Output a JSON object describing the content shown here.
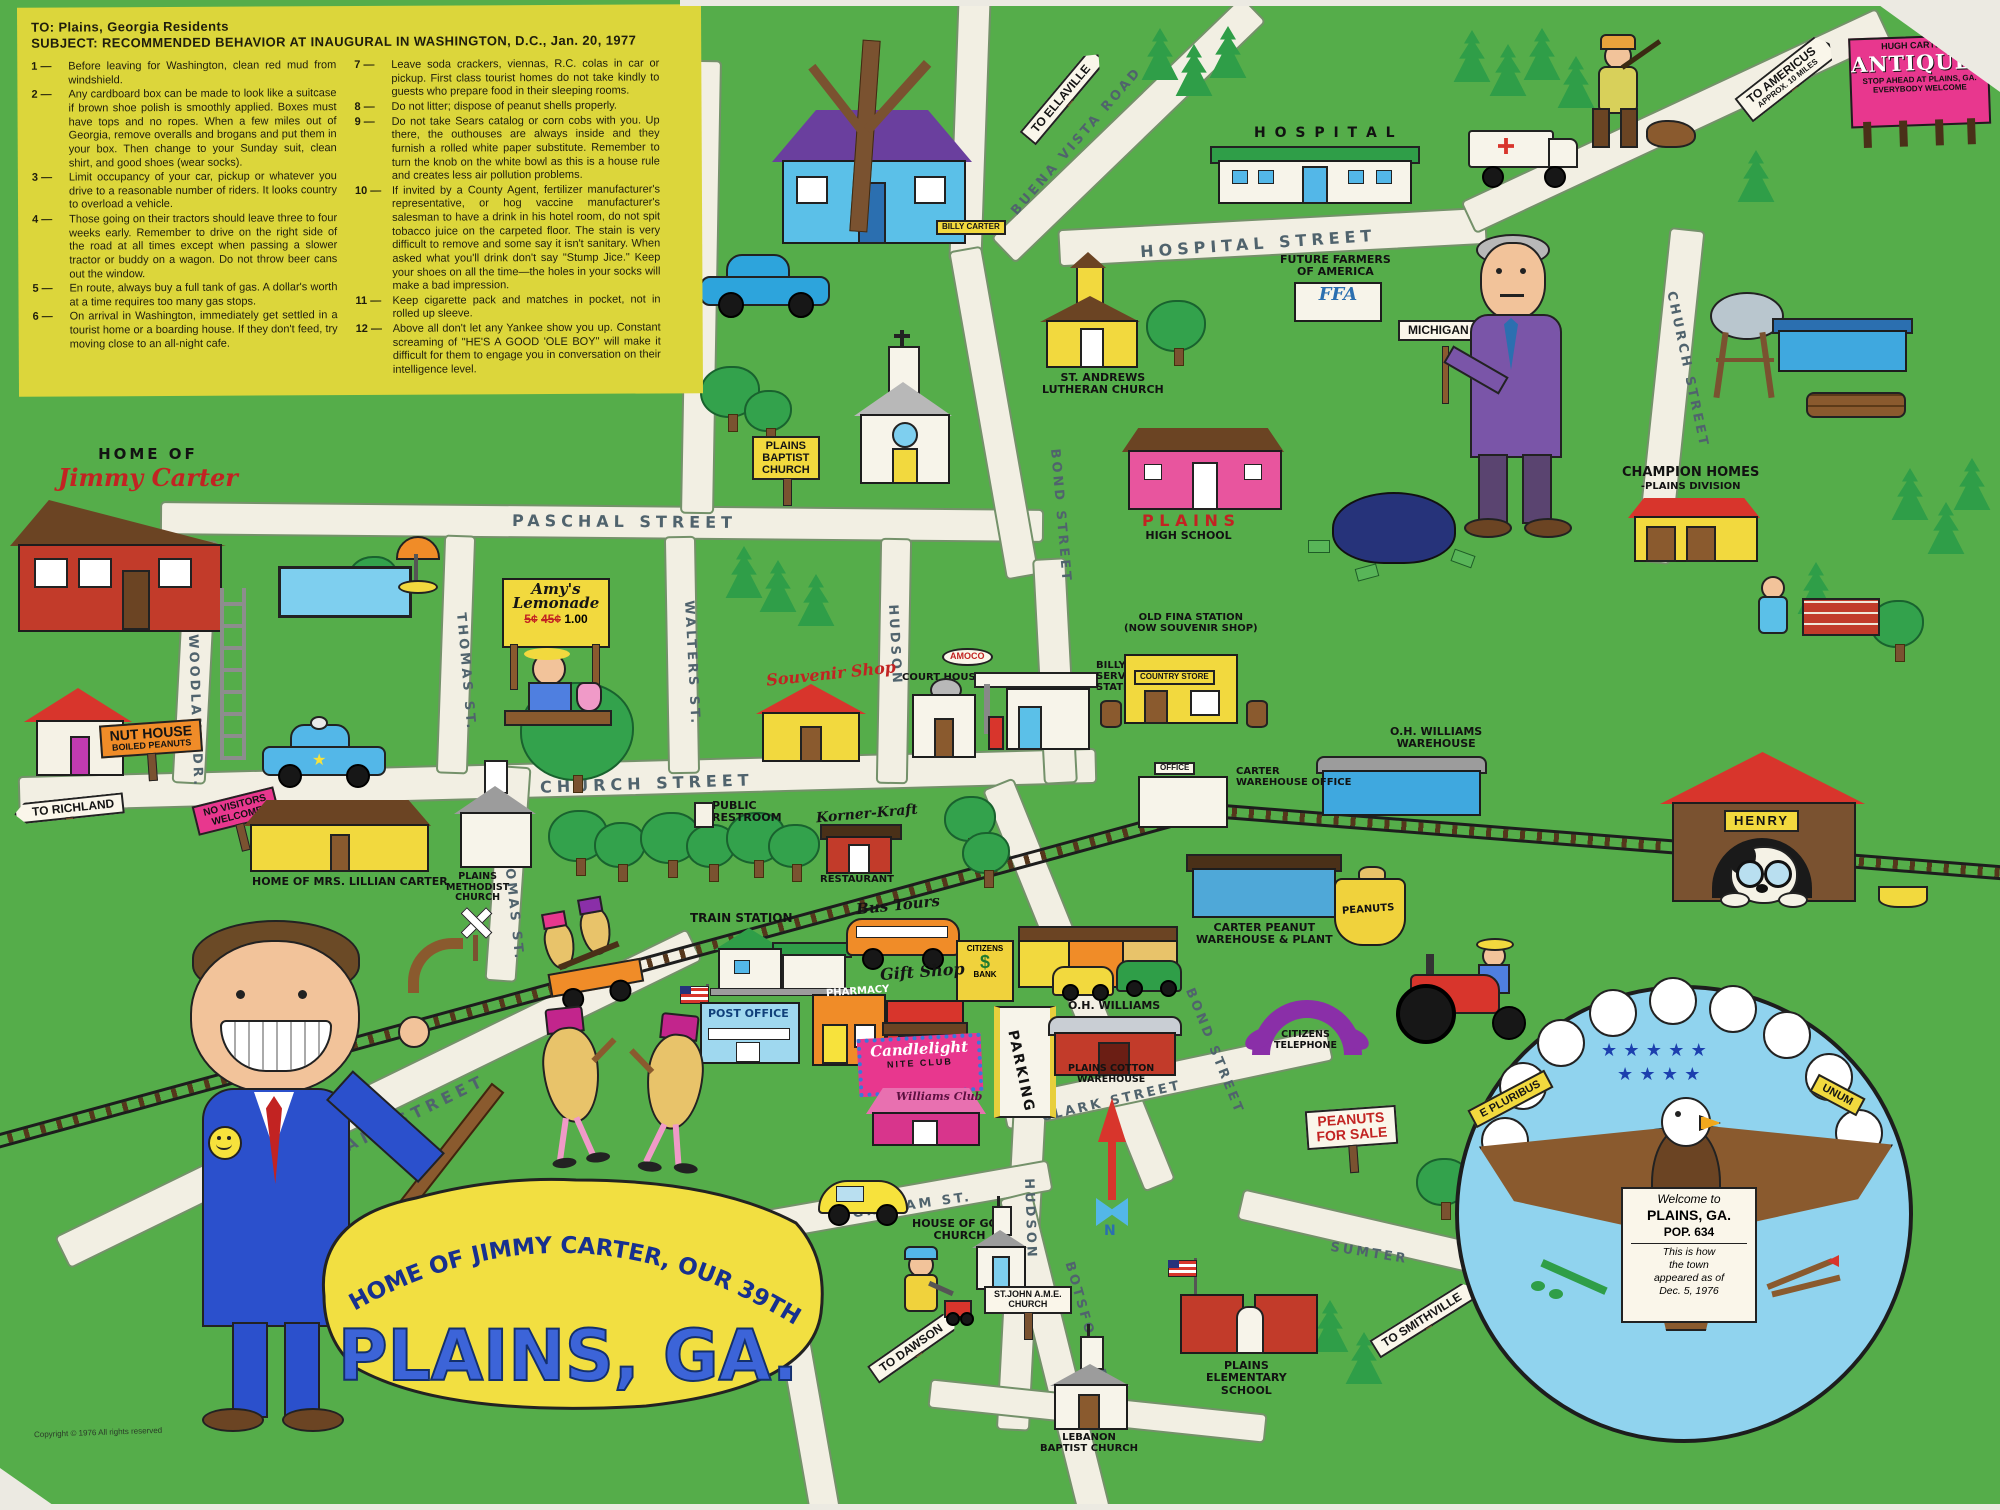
{
  "memo": {
    "to": "TO:  Plains, Georgia Residents",
    "subject": "SUBJECT:  RECOMMENDED  BEHAVIOR  AT  INAUGURAL  IN  WASHINGTON,  D.C.,  Jan.  20,  1977",
    "items": [
      {
        "n": "1 —",
        "t": "Before leaving for Washington, clean red mud from windshield."
      },
      {
        "n": "2 —",
        "t": "Any cardboard box can be made to look like a suitcase if brown shoe polish is smoothly applied. Boxes must have tops and no ropes. When a few miles out of Georgia, remove overalls and brogans and put them in your box. Then change to your Sunday suit, clean shirt, and good shoes (wear socks)."
      },
      {
        "n": "3 —",
        "t": "Limit occupancy of your car, pickup or whatever you drive to a reasonable number of riders. It looks country to overload a vehicle."
      },
      {
        "n": "4 —",
        "t": "Those going on their tractors should leave three to four weeks early. Remember to drive on the right side of the road at all times except when passing a slower tractor or buddy on a wagon. Do not throw beer cans out the window."
      },
      {
        "n": "5 —",
        "t": "En route, always buy a full tank of gas. A dollar's worth at a time requires too many gas stops."
      },
      {
        "n": "6 —",
        "t": "On arrival in Washington, immediately get settled in a tourist home or a boarding house. If they don't feed, try moving close to an all-night cafe."
      },
      {
        "n": "7 —",
        "t": "Leave soda crackers, viennas, R.C. colas in car or pickup. First class tourist homes do not take kindly to guests who prepare food in their sleeping rooms."
      },
      {
        "n": "8 —",
        "t": "Do not litter; dispose of peanut shells properly."
      },
      {
        "n": "9 —",
        "t": "Do not take Sears catalog or corn cobs with you. Up there, the outhouses are always inside and they furnish a rolled white paper substitute. Remember to turn the knob on the white bowl as this is a house rule and creates less air pollution problems."
      },
      {
        "n": "10 —",
        "t": "If invited by a County Agent, fertilizer manufacturer's representative, or hog vaccine manufacturer's salesman to have a drink in his hotel room, do not spit tobacco juice on the carpeted floor. The stain is very difficult to remove and some say it isn't sanitary. When asked what you'll drink don't say \"Stump Jice.\" Keep your shoes on all the time—the holes in your socks will make a bad impression."
      },
      {
        "n": "11 —",
        "t": "Keep cigarette pack and matches in pocket, not in rolled up sleeve."
      },
      {
        "n": "12 —",
        "t": "Above all don't let any Yankee show you up. Constant screaming of \"HE'S A GOOD 'OLE BOY\" will make it difficult for them to engage you in conversation on their intelligence level."
      }
    ]
  },
  "home_sign": {
    "line1": "HOME  OF",
    "line2": "Jimmy Carter"
  },
  "title": {
    "arc": "HOME OF JIMMY CARTER, OUR 39TH PRES.",
    "main": "PLAINS, GA."
  },
  "streets": {
    "paschal": "PASCHAL  STREET",
    "church_h": "CHURCH  STREET",
    "church_v": "CHURCH  STREET",
    "hospital": "HOSPITAL  STREET",
    "buena_vista": "BUENA  VISTA  ROAD",
    "bond_upper": "BOND  STREET",
    "bond_lower": "BOND  STREET",
    "thomas_upper": "THOMAS  ST.",
    "thomas_lower": "THOMAS  ST.",
    "walters": "WALTERS  ST.",
    "woodland": "WOODLAND  DR.",
    "hudson_upper": "HUDSON",
    "hudson_lower": "HUDSON",
    "main": "MAIN  STREET",
    "clark": "CLARK  STREET",
    "graham": "GRAHAM  ST.",
    "botsford": "BOTSFORD  ROAD",
    "sumter": "SUMTER"
  },
  "road_signs": {
    "to_richland": "TO RICHLAND",
    "to_ellaville": "TO ELLAVILLE",
    "to_americus": "TO AMERICUS",
    "to_americus_sub": "APPROX. 10 MILES",
    "to_dawson": "TO DAWSON",
    "to_smithville": "TO SMITHVILLE"
  },
  "billboard": {
    "owner": "HUGH CARTER'S",
    "name": "ANTIQUES",
    "line1": "STOP AHEAD AT PLAINS, GA.",
    "line2": "EVERYBODY WELCOME"
  },
  "labels": {
    "hospital": "H O S P I T A L",
    "ffa1": "FUTURE FARMERS",
    "ffa2": "OF AMERICA",
    "ffa_short": "FFA",
    "st_andrews1": "ST. ANDREWS",
    "st_andrews2": "LUTHERAN CHURCH",
    "baptist1": "PLAINS",
    "baptist2": "BAPTIST",
    "baptist3": "CHURCH",
    "high1": "P L A I N S",
    "high2": "HIGH SCHOOL",
    "michigan": "MICHIGAN",
    "champion1": "CHAMPION HOMES",
    "champion2": "-PLAINS DIVISION",
    "billy_box": "BILLY CARTER",
    "old_fina1": "OLD FINA STATION",
    "old_fina2": "(NOW SOUVENIR SHOP)",
    "country_store": "COUNTRY STORE",
    "billys1": "BILLY CARTER'S",
    "billys2": "SERVICE",
    "billys3": "STATION",
    "amoco": "AMOCO",
    "court": "COURT HOUSE",
    "souvenir": "Souvenir Shop",
    "oh_wh1": "O.H. WILLIAMS",
    "oh_wh2": "WAREHOUSE",
    "office": "OFFICE",
    "carter_office1": "CARTER",
    "carter_office2": "WAREHOUSE OFFICE",
    "henry": "HENRY",
    "nut1": "NUT HOUSE",
    "nut2": "BOILED PEANUTS",
    "no_visitors1": "NO VISITORS",
    "no_visitors2": "WELCOME",
    "lillian": "HOME OF MRS. LILLIAN CARTER",
    "methodist1": "PLAINS",
    "methodist2": "METHODIST",
    "methodist3": "CHURCH",
    "restroom1": "PUBLIC",
    "restroom2": "RESTROOM",
    "korner": "Korner-Kraft",
    "korner_sub": "RESTAURANT",
    "train": "TRAIN STATION",
    "bus": "Bus Tours",
    "bank1": "CITIZENS",
    "bank2": "$",
    "bank3": "BANK",
    "post_office": "POST OFFICE",
    "pharmacy": "PHARMACY",
    "gift": "Gift Shop",
    "candle1": "Candlelight",
    "candle2": "NITE CLUB",
    "williams1": "Williams",
    "williams2": "Club",
    "cotton1": "O.H. WILLIAMS",
    "cotton2": "PLAINS COTTON",
    "cotton3": "WAREHOUSE",
    "parking": "PARKING",
    "plant1": "CARTER PEANUT",
    "plant2": "WAREHOUSE & PLANT",
    "peanuts_bag": "PEANUTS",
    "phone1": "CITIZENS",
    "phone2": "TELEPHONE",
    "pfs1": "PEANUTS",
    "pfs2": "FOR SALE",
    "hog1": "HOUSE OF GOD",
    "hog2": "CHURCH",
    "stjohn1": "ST.JOHN A.M.E.",
    "stjohn2": "CHURCH",
    "lebanon1": "LEBANON",
    "lebanon2": "BAPTIST CHURCH",
    "elem1": "PLAINS",
    "elem2": "ELEMENTARY",
    "elem3": "SCHOOL",
    "amys1": "Amy's",
    "amys2": "Lemonade",
    "amys_old1": "5¢",
    "amys_old2": "45¢",
    "amys_new": "1.00",
    "compass_n": "N"
  },
  "seal": {
    "left": "E PLURIBUS",
    "right": "UNUM",
    "stars1": "★ ★ ★ ★ ★",
    "stars2": "★ ★ ★ ★",
    "welcome": "Welcome to",
    "city": "PLAINS, GA.",
    "pop": "POP. 634",
    "note1": "This is how",
    "note2": "the town",
    "note3": "appeared as of",
    "note4": "Dec. 5, 1976"
  },
  "footer": "Copyright © 1976 All rights reserved",
  "colors": {
    "map_green": "#55ad4a",
    "road": "#f2efe3",
    "memo_yellow": "#dcd63b",
    "sign_pink": "#e8378e",
    "title_yellow": "#f2df41",
    "title_blue": "#3c64d8",
    "seal_blue": "#90d3ee"
  }
}
